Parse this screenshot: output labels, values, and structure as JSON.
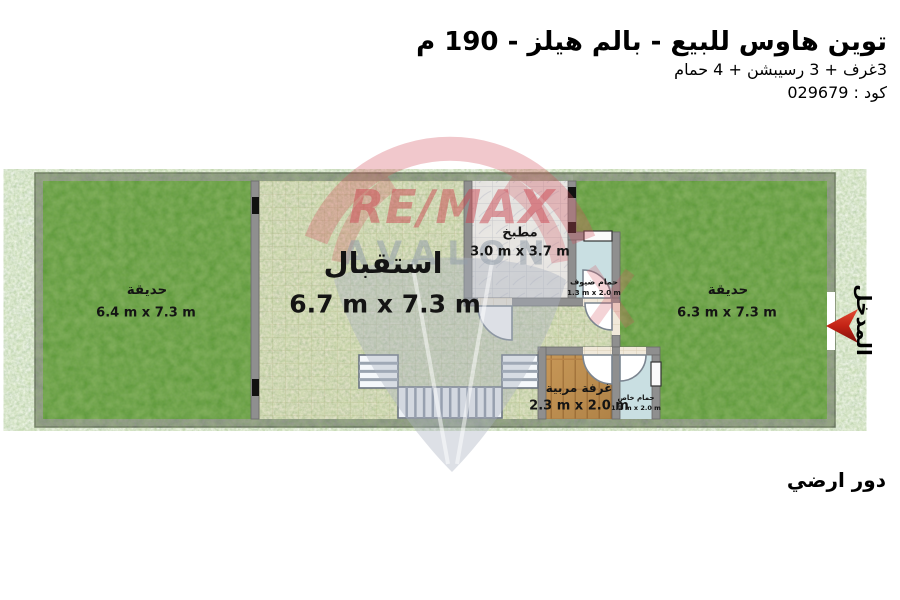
{
  "header": {
    "title": "توين هاوس للبيع - بالم هيلز - 190 م",
    "subtitle": "3غرف + 3 رسيبشن + 4 حمام",
    "code_line": "كود : 029679"
  },
  "plan": {
    "floor_label": "دور ارضي",
    "entrance_label": "المدخل",
    "rooms": {
      "garden_left": {
        "name": "حديقة",
        "dims": "6.4 m x 7.3 m"
      },
      "reception": {
        "name": "استقبال",
        "dims": "6.7 m x 7.3 m"
      },
      "kitchen": {
        "name": "مطبخ",
        "dims": "3.0 m x 3.7 m"
      },
      "guest_bath": {
        "name": "حمام ضيوف",
        "dims": "1.3 m x 2.0 m"
      },
      "nanny_room": {
        "name": "غرفة مربية",
        "dims": "2.3 m x 2.0 m"
      },
      "private_bath": {
        "name": "حمام خاص",
        "dims": "1.2 m x 2.0 m"
      },
      "garden_right": {
        "name": "حديقة",
        "dims": "6.3 m x 7.3 m"
      }
    }
  },
  "watermark": {
    "brand": "RE/MAX",
    "name": "AVALON"
  },
  "colors": {
    "grass": "#58992f",
    "wall": "#8f8f8f",
    "tile": "#f1e9da",
    "bath": "#c9dfe2",
    "wood": "#c79757",
    "arrow_red": "#b8281a",
    "watermark_red": "#d45560",
    "watermark_gray": "#a9b2c0"
  }
}
